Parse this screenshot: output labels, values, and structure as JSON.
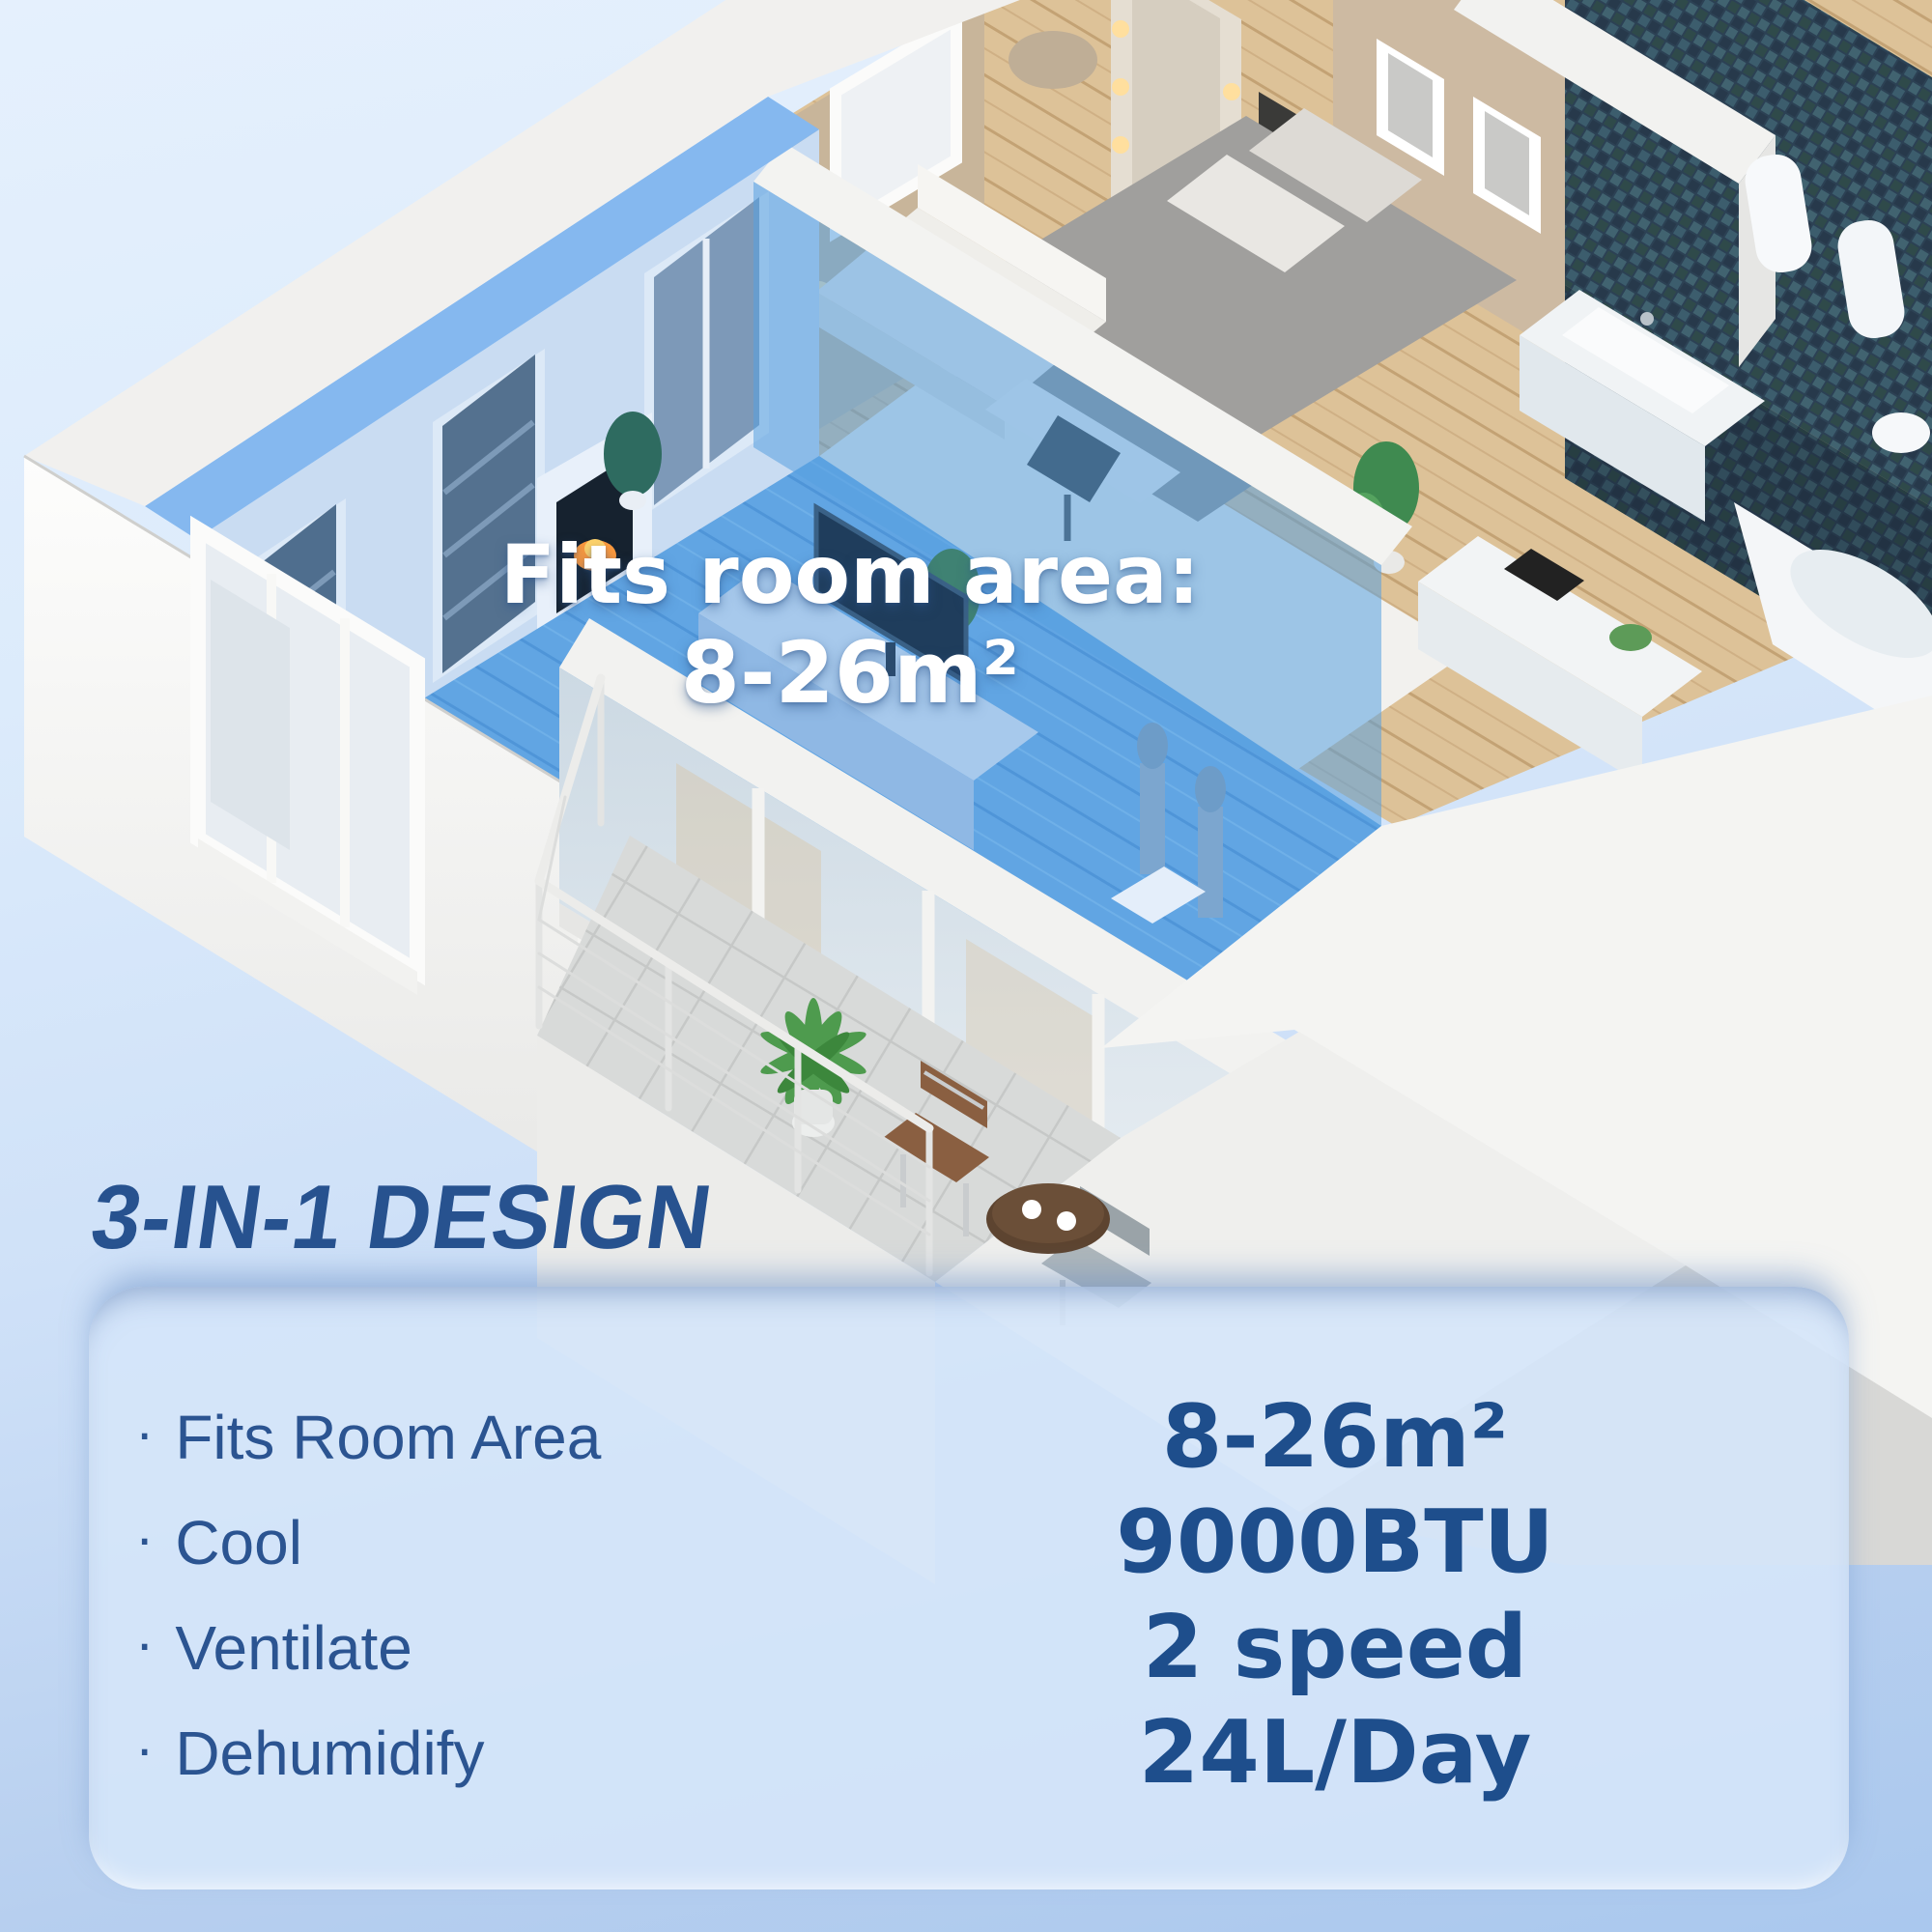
{
  "floorplan_overlay": {
    "line1": "Fits room area:",
    "line2": "8-26m²"
  },
  "design_section": {
    "heading": "3-IN-1 DESIGN",
    "bullet": "·",
    "features": [
      {
        "label": "Fits Room Area",
        "value": "8-26m²"
      },
      {
        "label": "Cool",
        "value": "9000BTU"
      },
      {
        "label": "Ventilate",
        "value": "2 speed"
      },
      {
        "label": "Dehumidify",
        "value": "24L/Day"
      }
    ]
  },
  "colors": {
    "heading_blue": "#27528f",
    "value_blue": "#1e4e8c",
    "feature_blue": "#2b5491",
    "highlight_blue": "#5ca2e2",
    "panel_background": "#d5e5fa",
    "background_top": "#e5f0fd",
    "background_bottom": "#aac8ee",
    "overlay_text": "#ffffff"
  }
}
